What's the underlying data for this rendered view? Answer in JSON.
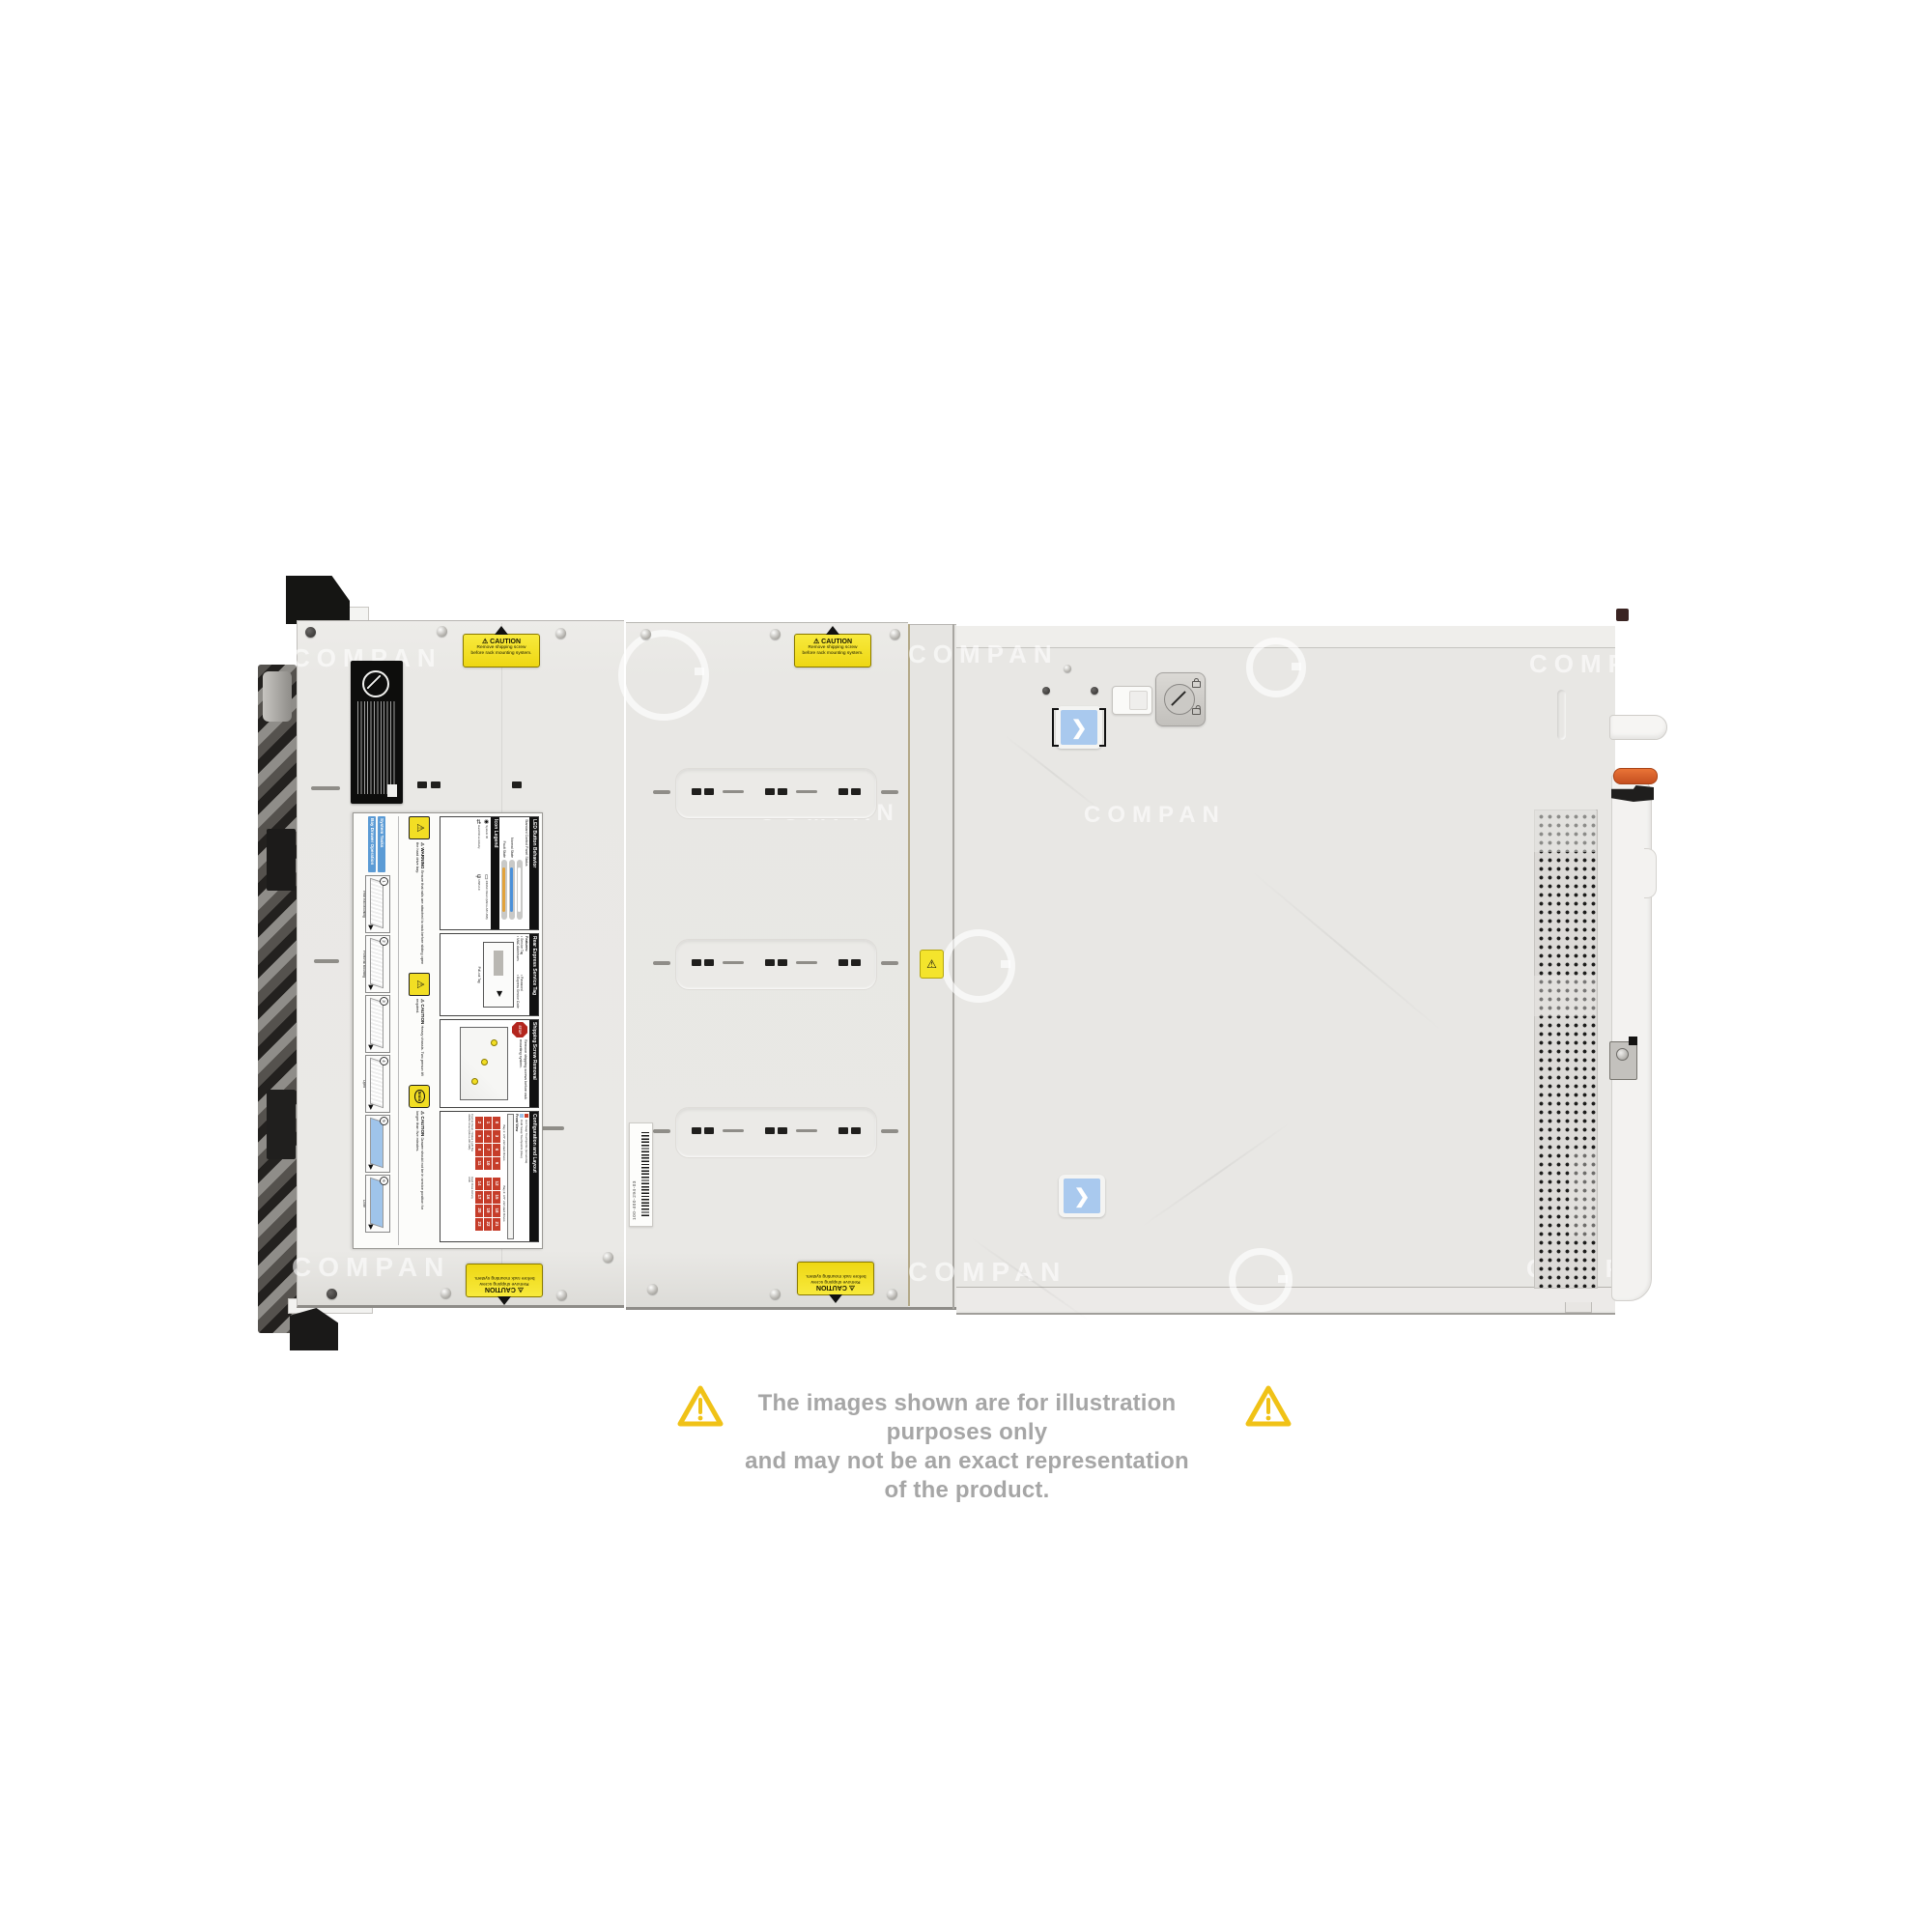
{
  "watermark": {
    "text": "COMPAN"
  },
  "disclaimer": {
    "line1": "The images shown are for illustration purposes only",
    "line2": "and may not be an exact representation of the product."
  },
  "stickers": {
    "caution": {
      "warn_symbol": "⚠",
      "title": "CAUTION",
      "line1": "Remove shipping screw",
      "line2": "before rack mounting system."
    },
    "barcode": {
      "text": "100-400-294-03"
    }
  },
  "panel": {
    "warn_symbol": "⚠",
    "led": {
      "header": "LED Button Behavior",
      "subtitle": "Standard Control Panel Status",
      "states": [
        {
          "label": "Normal State",
          "color": "#4a90d9"
        },
        {
          "label": "Fault State",
          "color": "#e2a23a"
        }
      ]
    },
    "icon_legend": {
      "header": "Icon Legend",
      "items": [
        "System ID",
        "iDRAC Direct (Micro-AB USB)",
        "Hard Drive Activity",
        "USB 2.0"
      ]
    },
    "service_tag": {
      "header": "Rear Express Service Tag",
      "features_title": "Features:",
      "features": [
        "Service Tag",
        "Password",
        "MAC Addresses",
        "Express Service Code"
      ],
      "caption": "Pull-out Tag"
    },
    "shipping": {
      "header": "Shipping Screw Removal",
      "stop_text": "STOP",
      "text": "Remove shipping screws before rack mounting system."
    },
    "config": {
      "header": "Configuration and Layout",
      "legend_hot": "Hot Swap Touchpoints (terracotta)",
      "legend_cold": "Cold Swap Touchpoints (blue)",
      "front_view_label": "Front View",
      "bay1_label": "Bay 1: 3.5\" x12 Hard Drives",
      "bay2_label": "Bay 2: 3.5\" x12 Hard Drives",
      "bay1_drives": [
        0,
        3,
        6,
        9,
        1,
        4,
        7,
        10,
        2,
        5,
        8,
        11
      ],
      "bay2_drives": [
        12,
        15,
        18,
        21,
        13,
        16,
        19,
        22,
        14,
        17,
        20,
        23
      ],
      "side_labels": [
        "Control Panel / Status Light Bar",
        "Hard Drive Activity",
        "iDRAC Direct (Micro-AB USB)",
        "USB"
      ]
    },
    "warning_rails": {
      "title": "WARNING",
      "text": "Ensure that rails are attached to rack before sliding open the hard drive bay."
    },
    "caution_heavy": {
      "title": "CAUTION",
      "text": "Heavy chassis. Two person lift required."
    },
    "caution_drawer": {
      "title": "CAUTION",
      "icon_text": "5min",
      "text": "Drawer should not be in service position for longer than five minutes."
    },
    "system_tasks": {
      "header1": "System Tasks",
      "header2": "Bay Drawer Operation",
      "steps": [
        {
          "num": "1",
          "label": "Rear Rail Mounting"
        },
        {
          "num": "2",
          "label": "Front Rail Mounting"
        },
        {
          "num": "3",
          "label": ""
        },
        {
          "num": "4",
          "label": "Open"
        },
        {
          "num": "5",
          "label": ""
        },
        {
          "num": "6",
          "label": "Close"
        }
      ]
    }
  },
  "colors": {
    "caution_yellow": "#f3e32b",
    "normal_state_blue": "#4a90d9",
    "fault_state_amber": "#e2a23a",
    "hot_swap_red": "#c63d2a",
    "cold_swap_blue": "#9fc4ea",
    "release_lever_orange": "#d85f2a",
    "chevron_sticker_blue": "#a9c9ee"
  }
}
